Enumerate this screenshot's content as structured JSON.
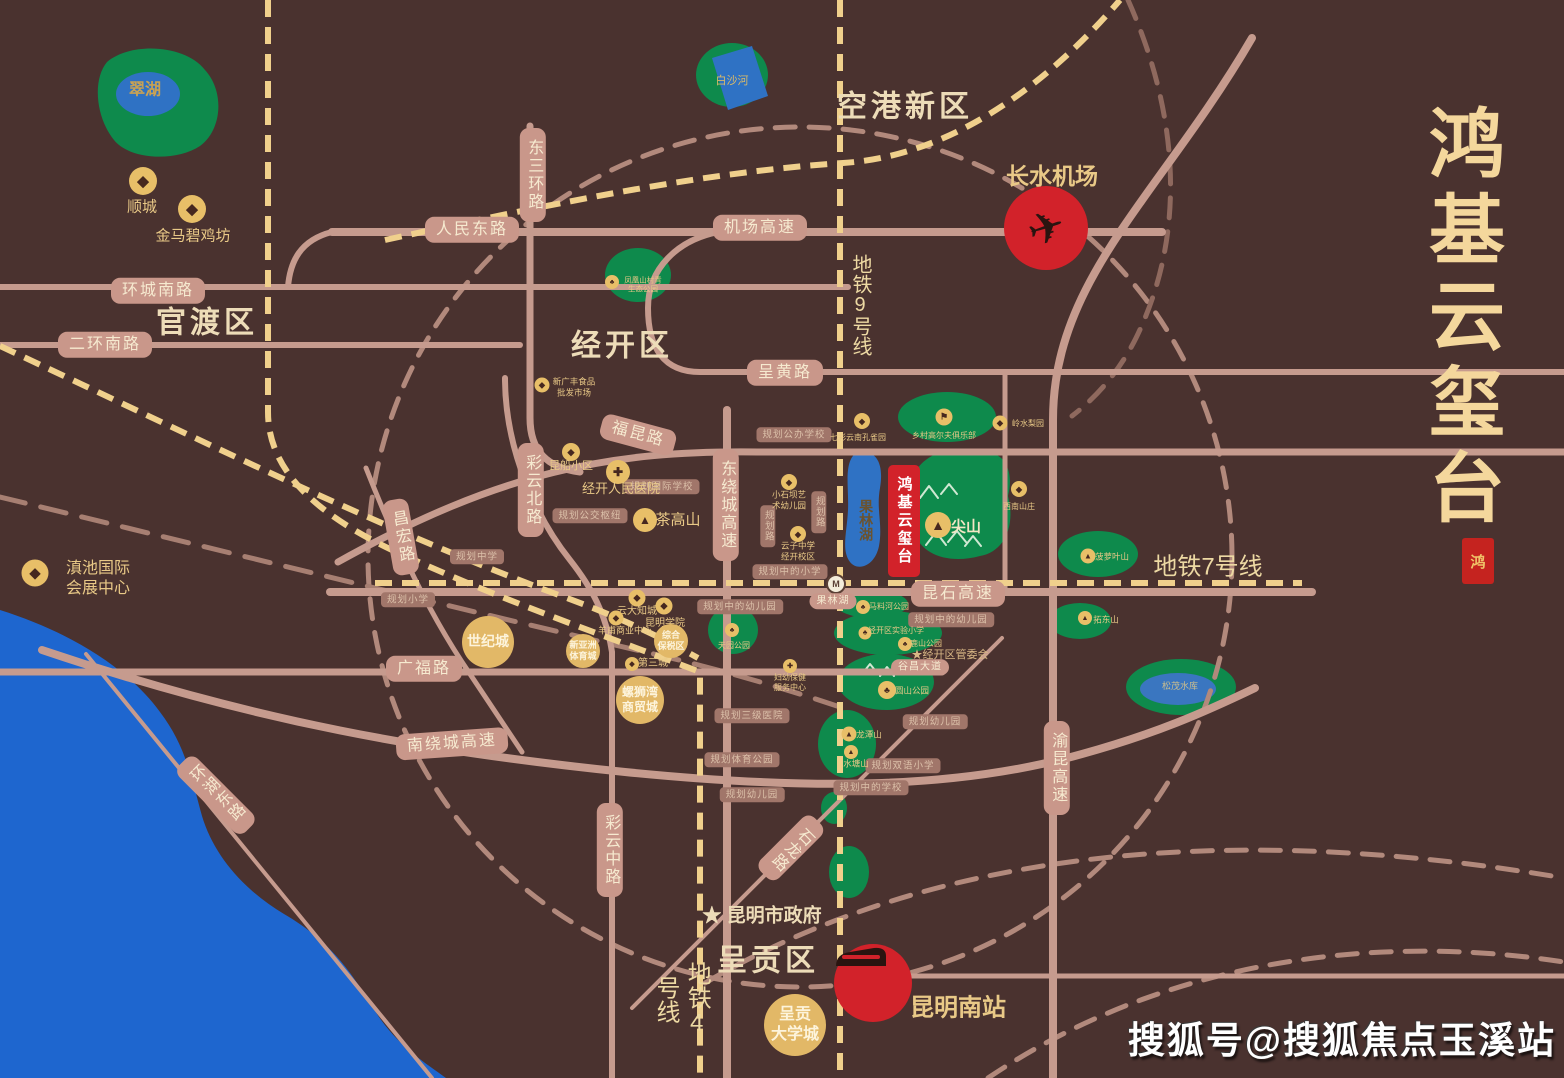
{
  "colors": {
    "background": "#4a322f",
    "road": "#c69b8e",
    "metro_dash": "#f0d08c",
    "ring_dash": "#b2897c",
    "green": "#0e8a4c",
    "lake": "#2f72c4",
    "dianchi": "#1e66cf",
    "accent_red": "#d2222a",
    "gold": "#e9c987",
    "pill_bg": "#c9978a",
    "title_gold": "#f4d79c"
  },
  "branding": {
    "title": "鸿基云玺台",
    "seal_char": "鸿"
  },
  "watermark": "搜狐号@搜狐焦点玉溪站",
  "project": {
    "name": "鸿基云玺台"
  },
  "station": {
    "logo": "M"
  },
  "texts": [
    {
      "n": "district-konggang",
      "t": "空港新区",
      "x": 905,
      "y": 107,
      "s": 30,
      "f": 1,
      "b": 1,
      "ls": 4,
      "c": "#eddcb8"
    },
    {
      "n": "district-guandu",
      "t": "官渡区",
      "x": 207,
      "y": 323,
      "s": 30,
      "f": 1,
      "b": 1,
      "ls": 4,
      "c": "#eddcb8"
    },
    {
      "n": "district-jingkai",
      "t": "经开区",
      "x": 622,
      "y": 346,
      "s": 30,
      "f": 1,
      "b": 1,
      "ls": 4,
      "c": "#eddcb8"
    },
    {
      "n": "district-chenggong",
      "t": "呈贡区",
      "x": 768,
      "y": 961,
      "s": 30,
      "f": 1,
      "b": 1,
      "ls": 4,
      "c": "#eddcb8"
    },
    {
      "n": "metro-9-label",
      "t": "地铁9号线",
      "x": 860,
      "y": 305,
      "s": 20,
      "v": 1,
      "c": "#edd9a3"
    },
    {
      "n": "metro-7-label",
      "t": "地铁7号线",
      "x": 1208,
      "y": 567,
      "s": 24,
      "c": "#edd9a3"
    },
    {
      "n": "metro-4-label",
      "t": "地铁4号线",
      "x": 681,
      "y": 999,
      "s": 24,
      "v": 1,
      "c": "#edd9a3"
    },
    {
      "n": "airport-label",
      "t": "长水机场",
      "x": 1052,
      "y": 177,
      "s": 23,
      "b": 1
    },
    {
      "n": "south-station-label",
      "t": "昆明南站",
      "x": 958,
      "y": 1008,
      "s": 24,
      "b": 1
    },
    {
      "n": "cuihu-label",
      "t": "翠湖",
      "x": 145,
      "y": 91,
      "s": 16,
      "b": 1,
      "c": "#c8a254"
    },
    {
      "n": "baishahe-label",
      "t": "白沙河",
      "x": 732,
      "y": 81,
      "s": 11,
      "c": "#d8b96a"
    },
    {
      "n": "guolinhu-label",
      "t": "果林湖",
      "x": 866,
      "y": 520,
      "s": 14,
      "v": 1,
      "b": 1,
      "c": "#6b532f"
    },
    {
      "n": "songmao-label",
      "t": "松茂水库",
      "x": 1180,
      "y": 687,
      "s": 9,
      "c": "#cbbd8e"
    },
    {
      "n": "jianshan-label",
      "t": "尖山",
      "x": 966,
      "y": 527,
      "s": 15,
      "b": 1,
      "c": "#f3e6c4"
    },
    {
      "n": "gov-label",
      "t": "★ 昆明市政府",
      "x": 762,
      "y": 917,
      "s": 19,
      "b": 1,
      "c": "#eddcb8"
    },
    {
      "n": "mgmt-label",
      "t": "★经开区管委会",
      "x": 950,
      "y": 655,
      "s": 11,
      "c": "#d9b886"
    }
  ],
  "road_pills": [
    {
      "n": "renmin-dong-road",
      "t": "人民东路",
      "x": 472,
      "y": 230
    },
    {
      "n": "jichang-expwy",
      "t": "机场高速",
      "x": 760,
      "y": 228
    },
    {
      "n": "huancheng-nan-road",
      "t": "环城南路",
      "x": 158,
      "y": 291
    },
    {
      "n": "erhuan-nan-road",
      "t": "二环南路",
      "x": 105,
      "y": 345
    },
    {
      "n": "dongsanhuan-road",
      "t": "东三环路",
      "x": 533,
      "y": 175,
      "v": 1
    },
    {
      "n": "chenghuang-road",
      "t": "呈黄路",
      "x": 785,
      "y": 373
    },
    {
      "n": "fukun-road",
      "t": "福昆路",
      "x": 638,
      "y": 435,
      "r": 15
    },
    {
      "n": "caiyun-bei-road",
      "t": "彩云北路",
      "x": 531,
      "y": 490,
      "v": 1
    },
    {
      "n": "changhong-road",
      "t": "昌宏路",
      "x": 401,
      "y": 537,
      "v": 1,
      "r": -10
    },
    {
      "n": "dongraocheng-expwy",
      "t": "东绕城高速",
      "x": 726,
      "y": 505,
      "v": 1
    },
    {
      "n": "kunshi-expwy",
      "t": "昆石高速",
      "x": 958,
      "y": 594
    },
    {
      "n": "guangfu-road",
      "t": "广福路",
      "x": 424,
      "y": 669
    },
    {
      "n": "nanraocheng-expwy",
      "t": "南绕城高速",
      "x": 452,
      "y": 744,
      "r": -4
    },
    {
      "n": "caiyun-zhong-road",
      "t": "彩云中路",
      "x": 610,
      "y": 850,
      "v": 1
    },
    {
      "n": "shilong-road",
      "t": "石龙路",
      "x": 791,
      "y": 848,
      "v": 1,
      "r": 45
    },
    {
      "n": "yukun-expwy",
      "t": "渝昆高速",
      "x": 1057,
      "y": 768,
      "v": 1
    },
    {
      "n": "huanhu-dong-road",
      "t": "环湖东路",
      "x": 216,
      "y": 795,
      "v": 1,
      "r": -45
    },
    {
      "n": "guolinhu-station-pill",
      "t": "果林湖",
      "x": 833,
      "y": 601,
      "s": 10
    },
    {
      "n": "guchang-road",
      "t": "谷昌大道",
      "x": 920,
      "y": 667,
      "s": 10
    }
  ],
  "plan_pills": [
    {
      "t": "规划公办学校",
      "x": 794,
      "y": 435
    },
    {
      "t": "规划国际学校",
      "x": 662,
      "y": 487
    },
    {
      "t": "规划公交枢纽",
      "x": 590,
      "y": 516
    },
    {
      "t": "规划中学",
      "x": 477,
      "y": 557
    },
    {
      "t": "规划小学",
      "x": 408,
      "y": 600
    },
    {
      "t": "规划中的小学",
      "x": 790,
      "y": 572
    },
    {
      "t": "规划中的幼儿园",
      "x": 740,
      "y": 607
    },
    {
      "t": "规划中的幼儿园",
      "x": 951,
      "y": 620
    },
    {
      "t": "规划三级医院",
      "x": 752,
      "y": 716
    },
    {
      "t": "规划体育公园",
      "x": 742,
      "y": 760
    },
    {
      "t": "规划幼儿园",
      "x": 752,
      "y": 795
    },
    {
      "t": "规划双语小学",
      "x": 903,
      "y": 766
    },
    {
      "t": "规划中的学校",
      "x": 871,
      "y": 788
    },
    {
      "t": "规划幼儿园",
      "x": 935,
      "y": 722
    },
    {
      "t": "规划路",
      "x": 768,
      "y": 526,
      "v": 1
    },
    {
      "t": "规划路",
      "x": 819,
      "y": 512,
      "v": 1
    }
  ],
  "pois": [
    {
      "n": "poi-shuncheng",
      "g": "◆",
      "x": 143,
      "y": 181,
      "d": 28,
      "t": "顺城",
      "lx": 142,
      "ly": 208,
      "z": 15
    },
    {
      "n": "poi-jinma-biji-fang",
      "g": "◆",
      "x": 192,
      "y": 209,
      "d": 28,
      "t": "金马碧鸡坊",
      "lx": 193,
      "ly": 237,
      "z": 15
    },
    {
      "n": "poi-dianchi-expo-center",
      "g": "◆",
      "x": 35,
      "y": 573,
      "d": 27,
      "t": "滇池国际\n会展中心",
      "lx": 98,
      "ly": 579,
      "z": 16
    },
    {
      "n": "poi-xinguangfeng-market",
      "g": "◆",
      "x": 542,
      "y": 385,
      "d": 15,
      "t": "新广丰食品\n批发市场",
      "lx": 574,
      "ly": 387,
      "z": 8.5
    },
    {
      "n": "poi-kunchuan-block",
      "g": "◆",
      "x": 571,
      "y": 452,
      "d": 18,
      "t": "昆船小区",
      "lx": 571,
      "ly": 467,
      "z": 11
    },
    {
      "n": "poi-jingkai-hospital",
      "g": "✚",
      "x": 618,
      "y": 472,
      "d": 24,
      "t": "经开人民医院",
      "lx": 621,
      "ly": 489,
      "z": 13
    },
    {
      "n": "poi-chagaoshan",
      "g": "▲",
      "x": 645,
      "y": 520,
      "d": 24,
      "t": "茶高山",
      "lx": 678,
      "ly": 521,
      "z": 15
    },
    {
      "n": "poi-peacock-park",
      "g": "◆",
      "x": 862,
      "y": 421,
      "d": 16,
      "t": "七彩云南孔雀园",
      "lx": 858,
      "ly": 438,
      "z": 8
    },
    {
      "n": "poi-golf-club",
      "g": "⚑",
      "x": 944,
      "y": 417,
      "d": 17,
      "t": "乡村高尔夫俱乐部",
      "lx": 944,
      "ly": 436,
      "z": 8
    },
    {
      "n": "poi-lingshui-liyuan",
      "g": "◆",
      "x": 1000,
      "y": 423,
      "d": 15,
      "t": "岭水梨园",
      "lx": 1028,
      "ly": 424,
      "z": 8
    },
    {
      "n": "poi-xinan-shanzhuang",
      "g": "◆",
      "x": 1019,
      "y": 489,
      "d": 16,
      "t": "西南山庄",
      "lx": 1019,
      "ly": 507,
      "z": 8
    },
    {
      "n": "poi-jianshan-peak",
      "g": "▲",
      "x": 938,
      "y": 525,
      "d": 26,
      "t": "",
      "lx": 0,
      "ly": 0,
      "z": 8
    },
    {
      "n": "poi-yunda-zhicheng",
      "g": "◆",
      "x": 637,
      "y": 598,
      "d": 17,
      "t": "云大知城",
      "lx": 637,
      "ly": 612,
      "z": 10
    },
    {
      "n": "poi-kunming-college",
      "g": "◆",
      "x": 664,
      "y": 606,
      "d": 17,
      "t": "昆明学院",
      "lx": 665,
      "ly": 624,
      "z": 10
    },
    {
      "n": "poi-yangfu-center",
      "g": "◆",
      "x": 616,
      "y": 618,
      "d": 15,
      "t": "羊甫商业中心",
      "lx": 625,
      "ly": 631,
      "z": 9
    },
    {
      "n": "poi-disancheng",
      "g": "◆",
      "x": 632,
      "y": 664,
      "d": 14,
      "t": "第三城",
      "lx": 653,
      "ly": 664,
      "z": 10
    },
    {
      "n": "poi-fuyou-center",
      "g": "✚",
      "x": 790,
      "y": 666,
      "d": 14,
      "t": "妇幼保健\n服务中心",
      "lx": 790,
      "ly": 683,
      "z": 8
    },
    {
      "n": "poi-xiaoshiba-kindergarten",
      "g": "◆",
      "x": 789,
      "y": 482,
      "d": 16,
      "t": "小石坝艺\n术幼儿园",
      "lx": 789,
      "ly": 500,
      "z": 8.5
    },
    {
      "n": "poi-yunzi-school",
      "g": "◆",
      "x": 798,
      "y": 534,
      "d": 16,
      "t": "云子中学\n经开校区",
      "lx": 798,
      "ly": 551,
      "z": 8.5
    },
    {
      "n": "poi-maliaohe-park",
      "g": "♣",
      "x": 863,
      "y": 607,
      "d": 14,
      "t": "马料河公园",
      "lx": 889,
      "ly": 607,
      "z": 8
    },
    {
      "n": "poi-experimental-school",
      "g": "♣",
      "x": 865,
      "y": 633,
      "d": 13,
      "t": "经开区实验小学",
      "lx": 896,
      "ly": 631,
      "z": 8
    },
    {
      "n": "poi-lushan-park",
      "g": "♣",
      "x": 905,
      "y": 644,
      "d": 14,
      "t": "鹿山公园",
      "lx": 926,
      "ly": 644,
      "z": 8
    },
    {
      "n": "poi-yuanshan-park",
      "g": "♣",
      "x": 887,
      "y": 690,
      "d": 18,
      "t": "圆山公园",
      "lx": 912,
      "ly": 691,
      "z": 8.5
    },
    {
      "n": "poi-tianyuan-park",
      "g": "♣",
      "x": 732,
      "y": 630,
      "d": 14,
      "t": "天园公园",
      "lx": 734,
      "ly": 646,
      "z": 8
    },
    {
      "n": "poi-longtanshan",
      "g": "▲",
      "x": 849,
      "y": 734,
      "d": 15,
      "t": "龙潭山",
      "lx": 869,
      "ly": 735,
      "z": 8.5
    },
    {
      "n": "poi-shuitangshan",
      "g": "▲",
      "x": 851,
      "y": 752,
      "d": 14,
      "t": "水塘山",
      "lx": 856,
      "ly": 764,
      "z": 8.5
    },
    {
      "n": "poi-boluoye-hill",
      "g": "▲",
      "x": 1088,
      "y": 556,
      "d": 15,
      "t": "菠萝叶山",
      "lx": 1112,
      "ly": 557,
      "z": 8.5
    },
    {
      "n": "poi-tuodong-hill",
      "g": "▲",
      "x": 1085,
      "y": 618,
      "d": 14,
      "t": "拓东山",
      "lx": 1106,
      "ly": 620,
      "z": 8.5
    },
    {
      "n": "poi-fenghuangshan-park",
      "g": "♣",
      "x": 612,
      "y": 282,
      "d": 14,
      "t": "凤凰山村青\n生态公园",
      "lx": 643,
      "ly": 285,
      "z": 7.5
    }
  ],
  "circles": [
    {
      "n": "landmark-shijicheng",
      "t": "世纪城",
      "x": 488,
      "y": 642,
      "d": 52,
      "z": 14
    },
    {
      "n": "landmark-luosiwan",
      "t": "螺狮湾\n商贸城",
      "x": 640,
      "y": 700,
      "d": 48,
      "z": 12
    },
    {
      "n": "landmark-xinyazhou",
      "t": "新亚洲\n体育城",
      "x": 583,
      "y": 651,
      "d": 34,
      "z": 9
    },
    {
      "n": "landmark-zonghe-baoshuiqu",
      "t": "综合\n保税区",
      "x": 671,
      "y": 641,
      "d": 34,
      "z": 9
    },
    {
      "n": "landmark-chenggong-univ-town",
      "t": "呈贡\n大学城",
      "x": 795,
      "y": 1025,
      "d": 62,
      "z": 16
    }
  ]
}
